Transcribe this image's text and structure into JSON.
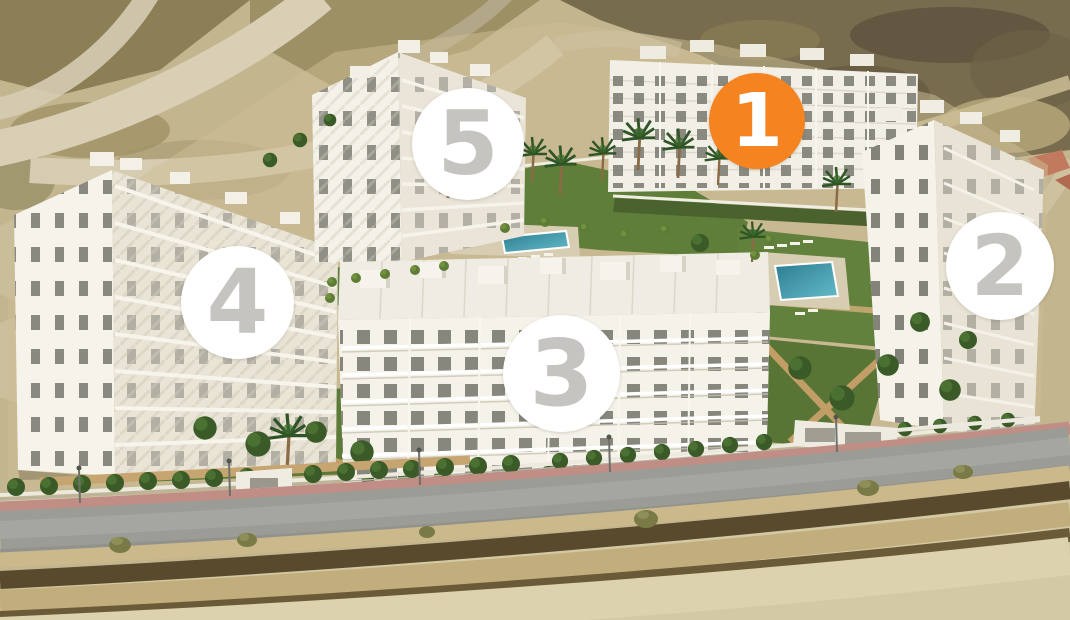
{
  "view": {
    "description": "Aerial 3D render of a five-block residential development with gardens, palm trees, two pools, perimeter fence and front road",
    "selected_block": "1"
  },
  "colors": {
    "marker_active_bg": "#F5831F",
    "marker_inactive_bg": "#FFFFFF",
    "marker_active_number": "#FFFFFF",
    "marker_inactive_number": "#C6C4C1"
  },
  "markers": [
    {
      "label": "1",
      "active": true
    },
    {
      "label": "2",
      "active": false
    },
    {
      "label": "3",
      "active": false
    },
    {
      "label": "4",
      "active": false
    },
    {
      "label": "5",
      "active": false
    }
  ]
}
